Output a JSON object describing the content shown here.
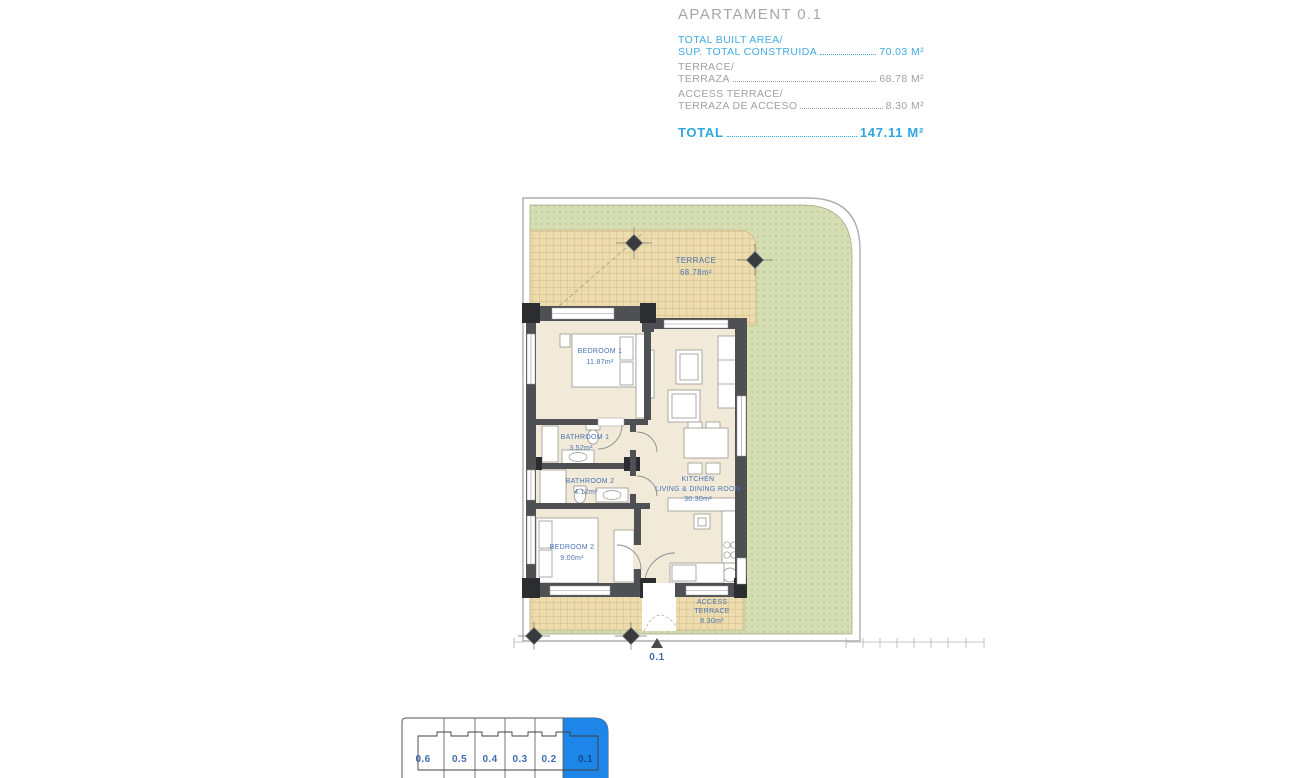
{
  "header": {
    "title": "APARTAMENT 0.1",
    "rows": [
      {
        "line1": "TOTAL BUILT AREA/",
        "line2": "SUP. TOTAL CONSTRUIDA",
        "value": "70.03 M²"
      },
      {
        "line1": "TERRACE/",
        "line2": "TERRAZA",
        "value": "68.78 M²"
      },
      {
        "line1": "ACCESS TERRACE/",
        "line2": "TERRAZA DE ACCESO",
        "value": "8.30 M²"
      }
    ],
    "total_label": "TOTAL",
    "total_value": "147.11 M²"
  },
  "plan": {
    "rooms": {
      "terrace": {
        "name": "TERRACE",
        "area": "68.78m²"
      },
      "bedroom1": {
        "name": "BEDROOM 1",
        "area": "11.87m²"
      },
      "bathroom1": {
        "name": "BATHROOM 1",
        "area": "3.52m²"
      },
      "bathroom2": {
        "name": "BATHROOM 2",
        "area": "4.12m²"
      },
      "bedroom2": {
        "name": "BEDROOM 2",
        "area": "9.00m²"
      },
      "kitchen": {
        "name": "KITCHEN",
        "name2": "LIVING & DINING ROOM",
        "area": "30.30m²"
      },
      "access_terrace": {
        "name": "ACCESS",
        "name2": "TERRACE",
        "area": "8.30m²"
      }
    },
    "entrance_label": "0.1"
  },
  "keyplan": {
    "units": [
      "0.6",
      "0.5",
      "0.4",
      "0.3",
      "0.2",
      "0.1"
    ],
    "highlighted_unit": "0.1",
    "highlight_color": "#1d86e8"
  },
  "colors": {
    "accent_blue": "#41abe1",
    "label_blue": "#4a73b4",
    "header_gray": "#9fa1a4",
    "garden_green": "#d5ddb2",
    "terrace_tan": "#ecdcae",
    "wall_gray": "#4e5054",
    "keyplan_highlight": "#1d86e8"
  }
}
